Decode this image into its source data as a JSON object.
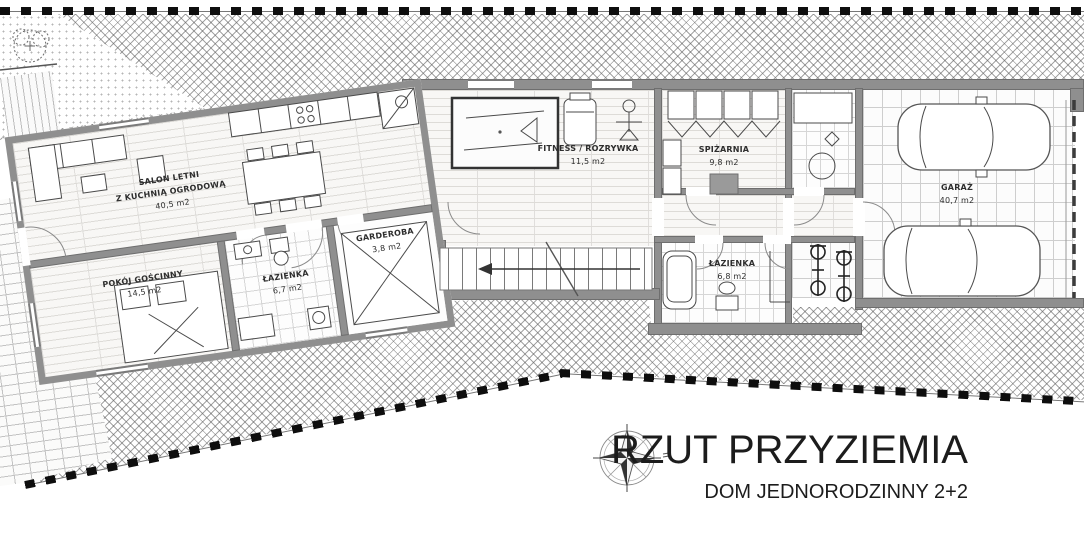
{
  "title_block": {
    "title": "RZUT PRZYZIEMIA",
    "subtitle": "DOM JEDNORODZINNY 2+2"
  },
  "rooms": [
    {
      "id": "salon",
      "name_line1": "SALON LETNI",
      "name_line2": "Z KUCHNIĄ OGRODOWĄ",
      "area": "40,5 m2"
    },
    {
      "id": "pokoj-goscinny",
      "name": "POKÓJ GOŚCINNY",
      "area": "14,5 m2"
    },
    {
      "id": "lazienka-1",
      "name": "ŁAZIENKA",
      "area": "6,7 m2"
    },
    {
      "id": "garderoba",
      "name": "GARDEROBA",
      "area": "3,8 m2"
    },
    {
      "id": "fitness",
      "name": "FITNESS / ROZRYWKA",
      "area": "11,5 m2"
    },
    {
      "id": "spizarnia",
      "name": "SPIŻARNIA",
      "area": "9,8 m2"
    },
    {
      "id": "lazienka-2",
      "name": "ŁAZIENKA",
      "area": "6,8 m2"
    },
    {
      "id": "garaz",
      "name": "GARAŻ",
      "area": "40,7 m2"
    }
  ],
  "icons": [
    "compass-rose-icon",
    "tree-icon",
    "stairs-arrow-icon"
  ],
  "colors": {
    "wall": "#8f8f8f",
    "hatch_line": "#5a5a5a",
    "boundary": "#0e0e0e",
    "text": "#2e2e2e"
  }
}
